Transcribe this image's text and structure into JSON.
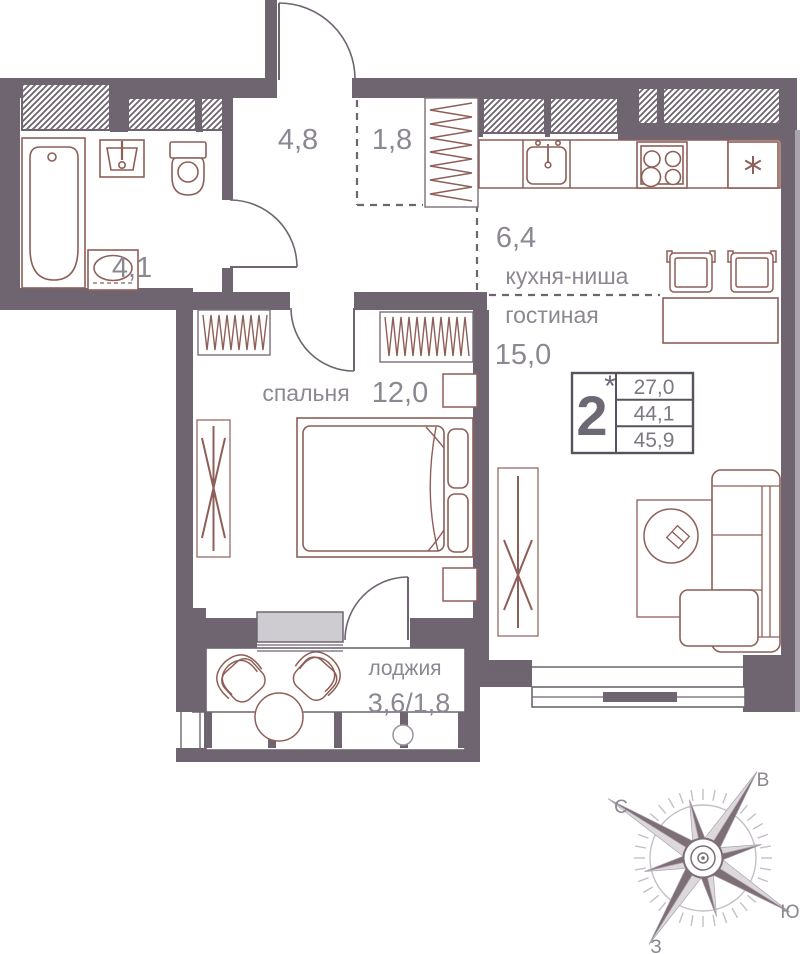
{
  "title": "2-room apartment floor plan",
  "rooms": {
    "hall": {
      "area": "4,8"
    },
    "closet": {
      "area": "1,8"
    },
    "bathroom": {
      "area": "4,1"
    },
    "kitchen": {
      "label": "кухня-ниша",
      "area": "6,4"
    },
    "living": {
      "label": "гостиная",
      "area": "15,0"
    },
    "bedroom": {
      "label": "спальня",
      "area": "12,0"
    },
    "loggia": {
      "label": "лоджия",
      "area": "3,6/1,8"
    }
  },
  "stats": {
    "rooms_count": "2",
    "note_mark": "*",
    "living_area": "27,0",
    "area_without_loggia": "44,1",
    "total_area": "45,9"
  },
  "compass": {
    "north": "С",
    "east": "В",
    "south": "Ю",
    "west": "З"
  },
  "icons": [
    "bathtub-icon",
    "sink-icon",
    "toilet-icon",
    "washing-machine-icon",
    "kitchen-sink-icon",
    "stove-icon",
    "fridge-icon",
    "wardrobe-hangers-icon",
    "bed-icon",
    "drying-rack-icon",
    "sofa-icon",
    "coffee-table-icon",
    "bar-table-icon",
    "stool-icon",
    "armchair-icon",
    "compass-rose-icon"
  ],
  "colors": {
    "wall": "#6F6571",
    "furniture": "#8E5F58",
    "text": "#8C8792",
    "window_sill": "#CFCCD1",
    "stat_border": "#57525e",
    "compass_dark": "#7E6E76",
    "compass_light": "#DCD8DC"
  }
}
